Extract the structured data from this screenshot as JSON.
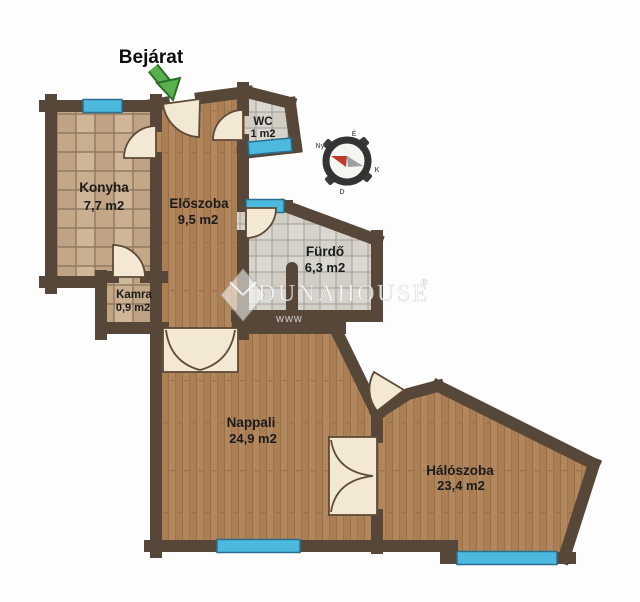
{
  "plan": {
    "entry": {
      "label": "Bejárat"
    },
    "rooms": {
      "konyha": {
        "name": "Konyha",
        "area": "7,7 m2"
      },
      "eloszoba": {
        "name": "Előszoba",
        "area": "9,5 m2"
      },
      "wc": {
        "name": "WC",
        "area": "1 m2"
      },
      "furdo": {
        "name": "Fürdő",
        "area": "6,3 m2"
      },
      "kamra": {
        "name": "Kamra",
        "area": "0,9 m2"
      },
      "nappali": {
        "name": "Nappali",
        "area": "24,9 m2"
      },
      "haloszoba": {
        "name": "Hálószoba",
        "area": "23,4 m2"
      }
    },
    "compass": {
      "n": "É",
      "e": "K",
      "s": "D",
      "w": "Ny"
    },
    "watermark": {
      "main": "DUNAHOUSE",
      "reg": "®",
      "sub": "www"
    },
    "colors": {
      "wall": "#574739",
      "wood_floor": "#b3875d",
      "kitchen_tile": "#c9af90",
      "bath_tile": "#d6d3cc",
      "window": "#4cb9de",
      "door": "#f2e8d4",
      "entry_arrow": "#58b14c",
      "compass_needle_north": "#c0392b",
      "compass_needle_south": "#9aa0a0"
    }
  }
}
